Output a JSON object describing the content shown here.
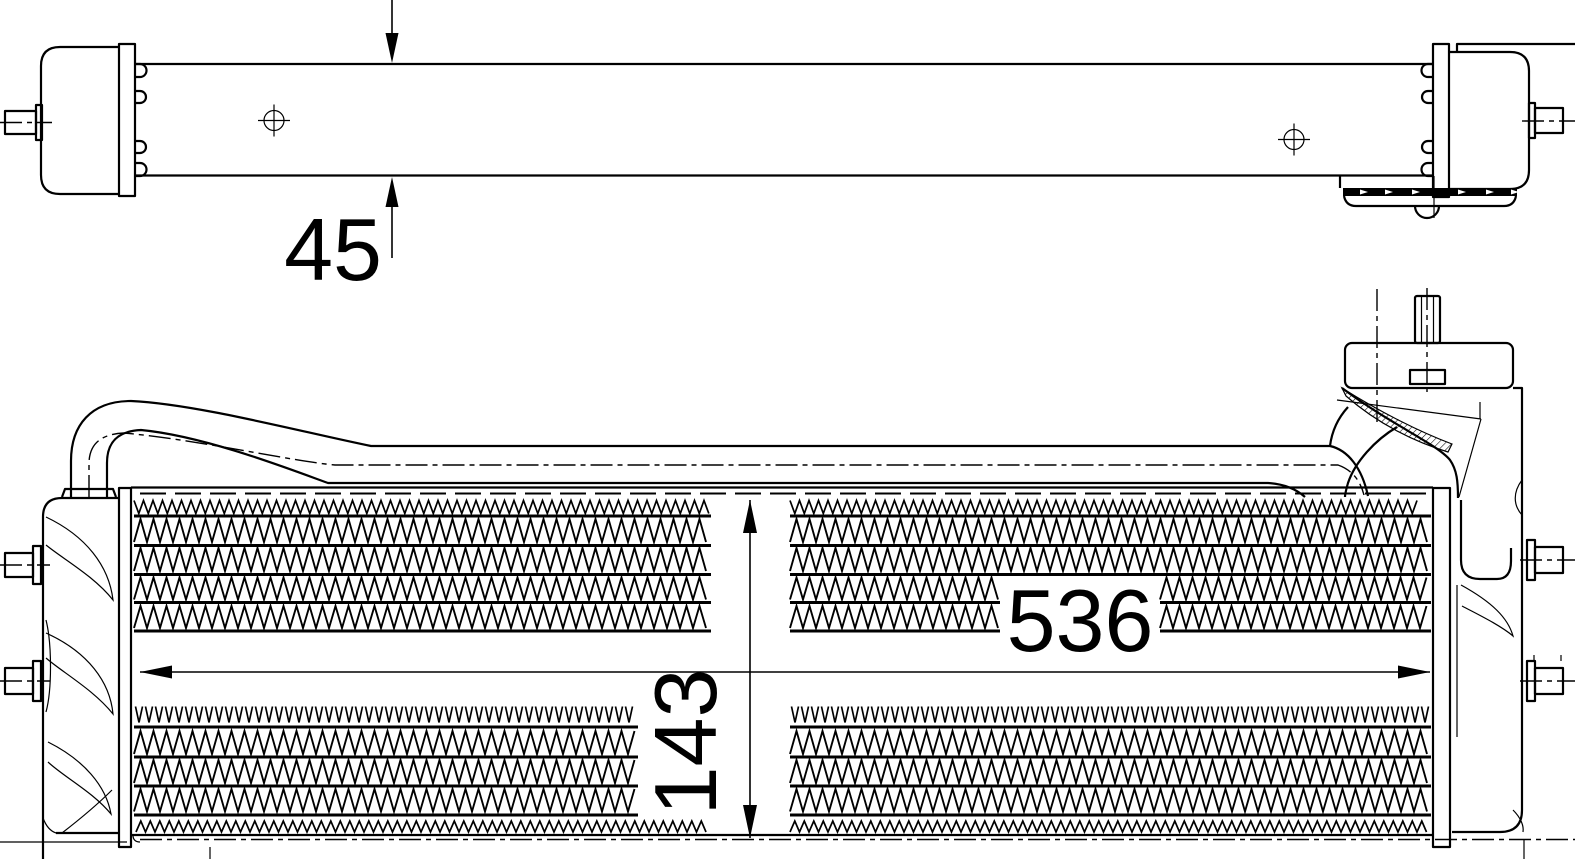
{
  "drawing": {
    "kind": "technical-dimension-drawing",
    "colors": {
      "ink": "#000000",
      "paper": "#ffffff"
    },
    "dimensions": {
      "thickness": "45",
      "length": "536",
      "height": "143"
    }
  }
}
